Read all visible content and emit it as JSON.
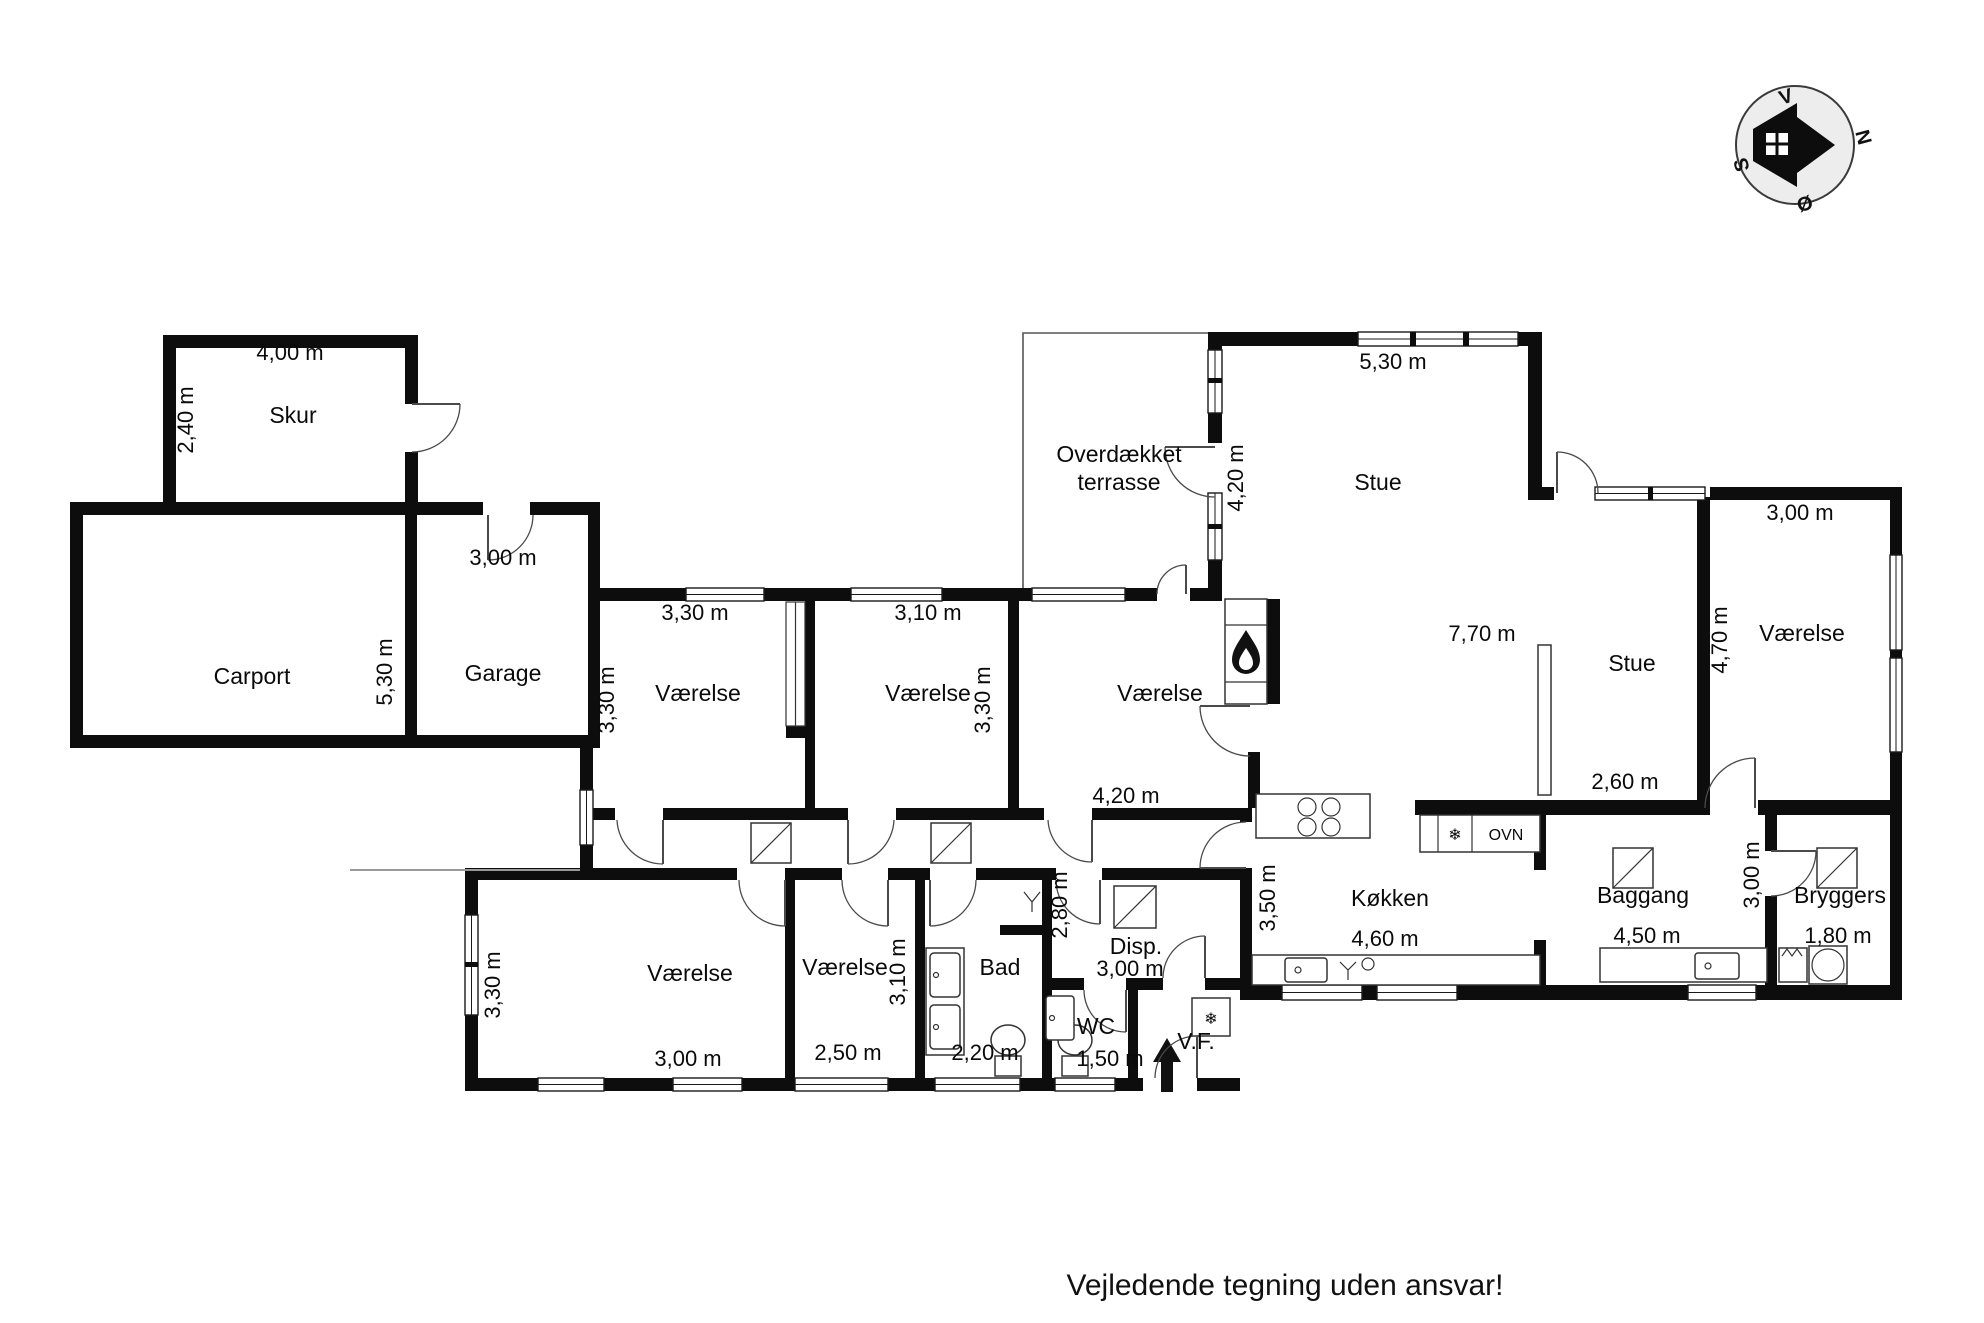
{
  "footer": {
    "disclaimer": "Vejledende tegning uden ansvar!"
  },
  "compass": {
    "north": "N",
    "west": "V",
    "south": "S",
    "east": "Ø"
  },
  "symbols": {
    "snowflake": "❄",
    "oven_label": "OVN"
  },
  "rooms": {
    "skur": {
      "name": "Skur",
      "width_label": "4,00 m",
      "depth_label": "2,40 m"
    },
    "carport": {
      "name": "Carport",
      "depth_label": "5,30 m"
    },
    "garage": {
      "name": "Garage",
      "width_label": "3,00 m"
    },
    "vaerelse_nw": {
      "name": "Værelse",
      "width_label": "3,30 m",
      "depth_label": "3,30 m"
    },
    "vaerelse_n": {
      "name": "Værelse",
      "width_label": "3,10 m",
      "depth_label": "3,30 m"
    },
    "vaerelse_ne": {
      "name": "Værelse",
      "width_label": "4,20 m"
    },
    "terrasse": {
      "name_line1": "Overdækket",
      "name_line2": "terrasse",
      "depth_label": "4,20 m"
    },
    "stue_nord": {
      "name": "Stue",
      "width_label": "5,30 m"
    },
    "stue": {
      "name": "Stue",
      "width_label": "7,70 m",
      "width2_label": "2,60 m"
    },
    "vaerelse_e": {
      "name": "Værelse",
      "width_label": "3,00 m",
      "depth_label": "4,70 m"
    },
    "vaerelse_sw": {
      "name": "Værelse",
      "width_label": "3,00 m",
      "depth_label": "3,30 m"
    },
    "vaerelse_s": {
      "name": "Værelse",
      "width_label": "2,50 m",
      "depth_label": "3,10 m"
    },
    "bad": {
      "name": "Bad",
      "width_label": "2,20 m"
    },
    "wc": {
      "name": "WC",
      "width_label": "1,50 m"
    },
    "vf": {
      "name": "V.F."
    },
    "disp": {
      "name": "Disp.",
      "width_label": "3,00 m",
      "depth_label": "2,80 m"
    },
    "kokken": {
      "name": "Køkken",
      "width_label": "4,60 m",
      "depth_label": "3,50 m"
    },
    "baggang": {
      "name": "Baggang",
      "width_label": "4,50 m",
      "depth_label": "3,00 m"
    },
    "bryggers": {
      "name": "Bryggers",
      "width_label": "1,80 m"
    }
  }
}
